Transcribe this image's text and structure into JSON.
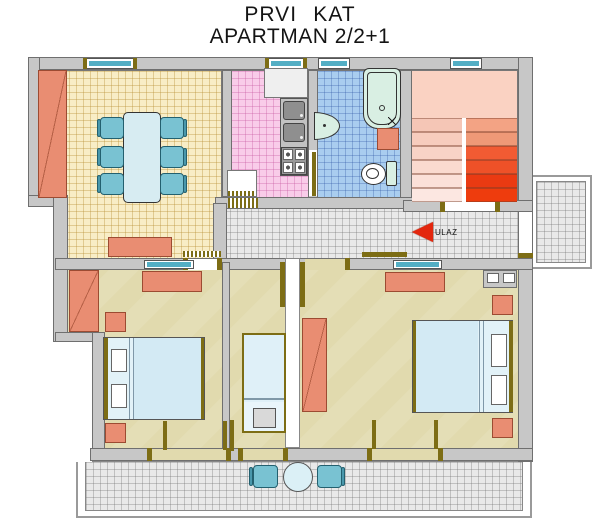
{
  "title": {
    "line1": "PRVI KAT",
    "line2": "APARTMAN 2/2+1"
  },
  "entrance": {
    "label": "ULAZ",
    "arrow_direction": "left",
    "icon": "arrow-left-icon"
  },
  "colors": {
    "wall": "#c7c7c7",
    "wall_edge": "#6f6f6f",
    "dining_floor": "#f8edc6",
    "kitchen_floor": "#f9cce9",
    "bath_floor": "#a9cdef",
    "hallway_floor": "#e9e9e9",
    "bedroom_floor": "#e1daae",
    "stairs_landing": "#fad2c2",
    "furniture_orange": "#e98d72",
    "furniture_edge": "#9c4b32",
    "chair_teal": "#79c2d2",
    "bed_blue": "#d3eaf4",
    "fixture_mint": "#d9efe3",
    "window_teal": "#53aec4",
    "door_olive": "#7d6d15",
    "arrow_red": "#e3270e"
  },
  "stairs": {
    "left_flight": [
      "#f5c6b6",
      "#f7ccbd",
      "#f8d3c6",
      "#fadacf",
      "#fbe0d8",
      "#fce7e1"
    ],
    "right_flight": [
      "#f3a384",
      "#ef9977",
      "#f25b33",
      "#ee5128",
      "#ea3a12",
      "#ee3c0d"
    ]
  }
}
